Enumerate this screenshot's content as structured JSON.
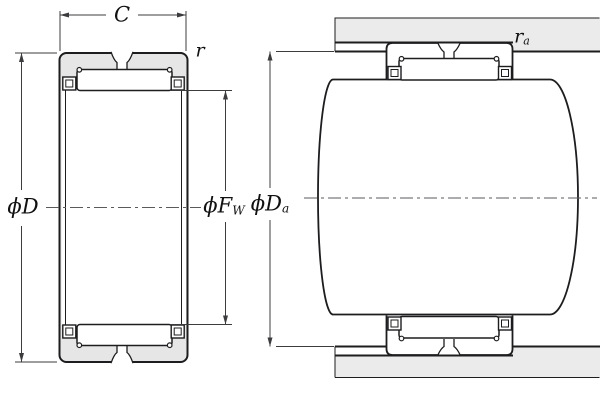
{
  "figure": {
    "kind": "bearing-engineering-drawing"
  },
  "dimensions": {
    "c": {
      "main": "C",
      "sub": ""
    },
    "r": {
      "main": "r",
      "sub": ""
    },
    "d": {
      "main": "ϕD",
      "sub": ""
    },
    "fw": {
      "main": "ϕF",
      "sub": "W"
    },
    "da": {
      "main": "ϕD",
      "sub": "a"
    },
    "ra": {
      "main": "r",
      "sub": "a"
    }
  },
  "colors": {
    "line": "#1d1d1f",
    "dim_line": "#3c3c3e",
    "centerline": "#5a5a5c",
    "ring_fill": "#e6e6e7",
    "housing_fill": "#ebebeb",
    "background": "#ffffff"
  }
}
